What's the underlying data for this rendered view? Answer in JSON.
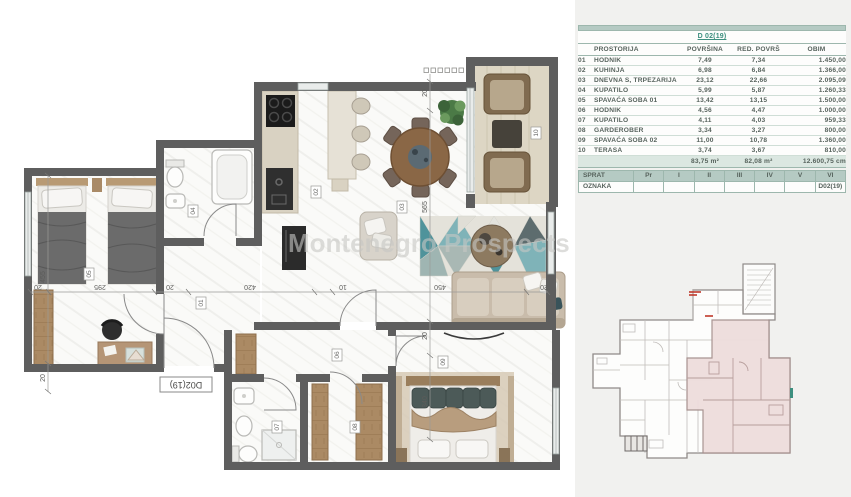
{
  "watermark": "Montenegro Prospects",
  "area_table": {
    "title": "D 02(19)",
    "headers": {
      "name": "PROSTORIJA",
      "area": "POVRŠINA",
      "red": "RED. POVRŠ",
      "obim": "OBIM"
    },
    "rows": [
      {
        "num": "01",
        "name": "HODNIK",
        "area": "7,49",
        "red": "7,34",
        "obim": "1.450,00"
      },
      {
        "num": "02",
        "name": "KUHINJA",
        "area": "6,98",
        "red": "6,84",
        "obim": "1.366,00"
      },
      {
        "num": "03",
        "name": "DNEVNA S, TRPEZARIJA",
        "area": "23,12",
        "red": "22,66",
        "obim": "2.095,09"
      },
      {
        "num": "04",
        "name": "KUPATILO",
        "area": "5,99",
        "red": "5,87",
        "obim": "1.260,33"
      },
      {
        "num": "05",
        "name": "SPAVAĆA SOBA 01",
        "area": "13,42",
        "red": "13,15",
        "obim": "1.500,00"
      },
      {
        "num": "06",
        "name": "HODNIK",
        "area": "4,56",
        "red": "4,47",
        "obim": "1.000,00"
      },
      {
        "num": "07",
        "name": "KUPATILO",
        "area": "4,11",
        "red": "4,03",
        "obim": "959,33"
      },
      {
        "num": "08",
        "name": "GARDEROBER",
        "area": "3,34",
        "red": "3,27",
        "obim": "800,00"
      },
      {
        "num": "09",
        "name": "SPAVAĆA SOBA 02",
        "area": "11,00",
        "red": "10,78",
        "obim": "1.360,00"
      },
      {
        "num": "10",
        "name": "TERASA",
        "area": "3,74",
        "red": "3,67",
        "obim": "810,00"
      }
    ],
    "totals": {
      "area": "83,75 m²",
      "red": "82,08 m²",
      "obim": "12.600,75 cm"
    }
  },
  "floor_table": {
    "row1": [
      "SPRAT",
      "Pr",
      "I",
      "II",
      "III",
      "IV",
      "V",
      "VI"
    ],
    "row2_label": "OZNAKA",
    "row2_cells": [
      "",
      "",
      "",
      "",
      "",
      ""
    ],
    "row2_value": "D02(19)"
  },
  "floorplan": {
    "entrance_label": "D02(19)",
    "rooms": [
      "01",
      "02",
      "03",
      "04",
      "05",
      "06",
      "07",
      "08",
      "09",
      "10"
    ],
    "dims_h": [
      "20",
      "295",
      "20",
      "420",
      "10",
      "450",
      "20"
    ],
    "dims_v_left": [
      "455",
      "20"
    ],
    "dims_v_mid": [
      "20",
      "565",
      "20",
      "340"
    ]
  },
  "colors": {
    "teal_band": "#b5cac3",
    "accent": "#3d8f7f",
    "wall": "#5e5e5e",
    "highlight_unit": "#eedddc",
    "rug_teal": "#4f939b"
  }
}
